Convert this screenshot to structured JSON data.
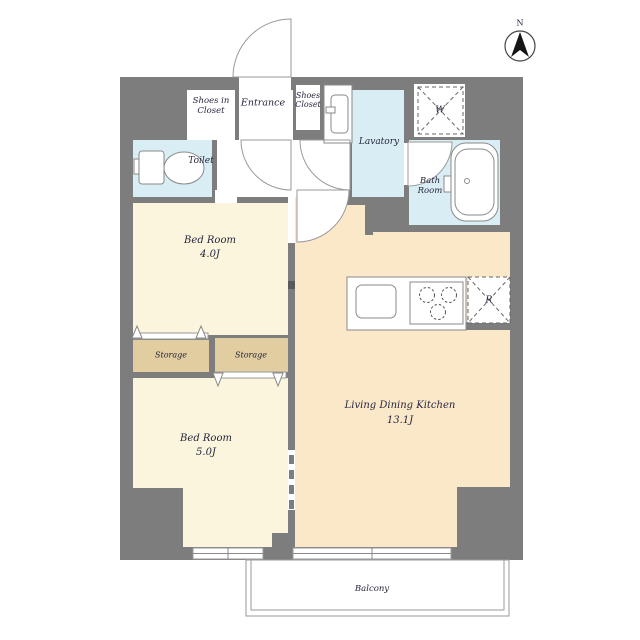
{
  "compass": {
    "north_label": "N"
  },
  "rooms": {
    "shoes_in_closet": {
      "line1": "Shoes in",
      "line2": "Closet"
    },
    "entrance": {
      "label": "Entrance"
    },
    "shoes_closet": {
      "line1": "Shoes",
      "line2": "Closet"
    },
    "lavatory": {
      "label": "Lavatory"
    },
    "toilet": {
      "label": "Toilet"
    },
    "bath_room": {
      "line1": "Bath",
      "line2": "Room"
    },
    "bedroom_small": {
      "label": "Bed Room",
      "size": "4.0J"
    },
    "bedroom_large": {
      "label": "Bed Room",
      "size": "5.0J"
    },
    "living_dining_kitchen": {
      "label": "Living Dining Kitchen",
      "size": "13.1J"
    },
    "storage_left": {
      "label": "Storage"
    },
    "storage_right": {
      "label": "Storage"
    },
    "balcony": {
      "label": "Balcony"
    }
  },
  "fixtures": {
    "washing_machine": {
      "label": "W"
    },
    "refrigerator": {
      "label": "R"
    }
  },
  "colors": {
    "wall": "#7d7d7d",
    "wet_area": "#d9edf4",
    "bedroom": "#faf5dc",
    "ldk": "#fbe8c9",
    "storage": "#e2cda1",
    "outline": "#8a8a8a",
    "text": "#26263e"
  }
}
